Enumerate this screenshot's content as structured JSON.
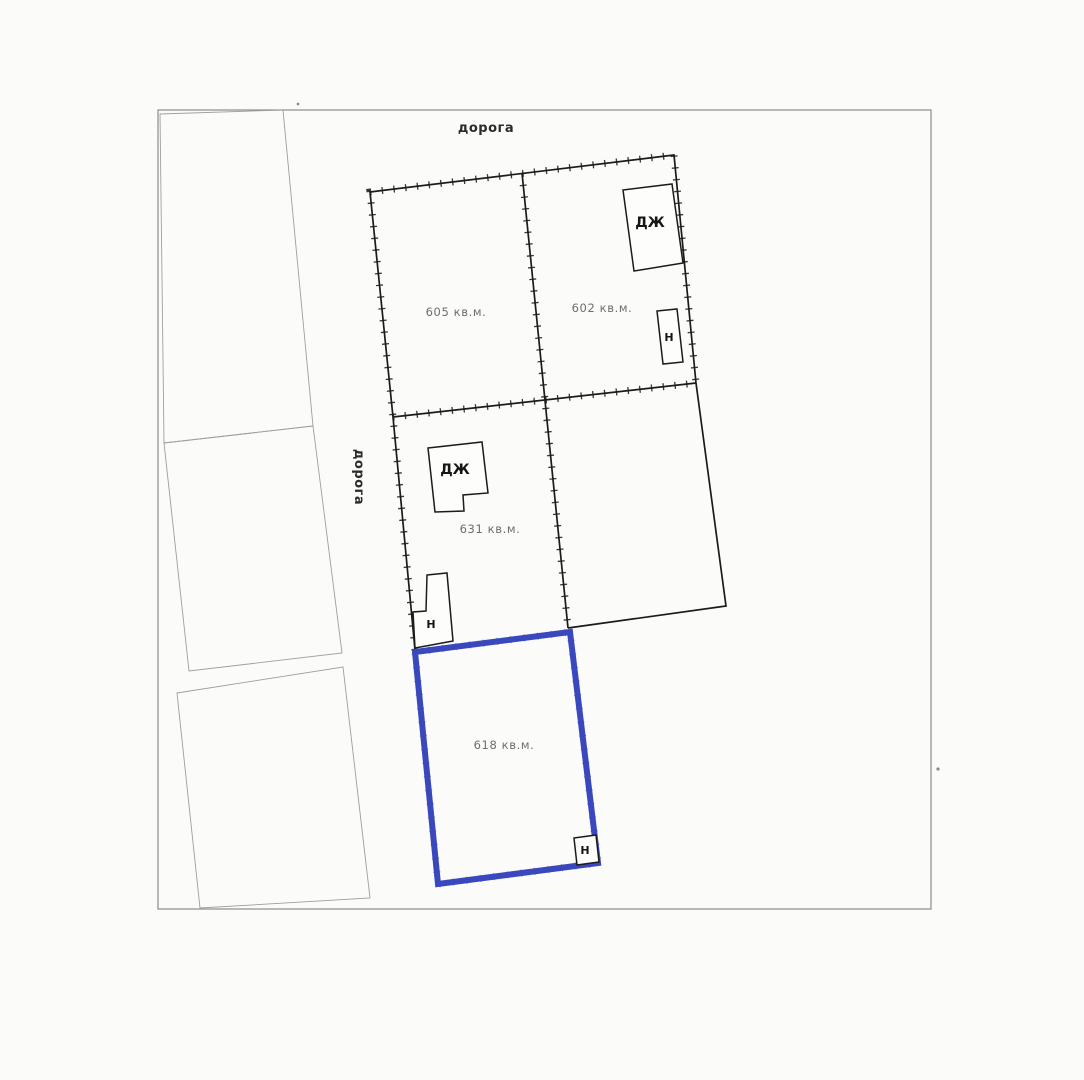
{
  "document_type": "cadastral-site-plan-scan",
  "colors": {
    "highlight": "#3a48be",
    "line": "#1b1b1b",
    "faint": "#9e9e9e",
    "sheet_border": "#8c8c8c",
    "area_text": "#6e6e6e",
    "label_text": "#2b2b2b",
    "background": "#fbfbfa"
  },
  "labels": {
    "road_top": "дорога",
    "road_left": "дорога"
  },
  "parcels": {
    "p605": {
      "area": "605 кв.м."
    },
    "p602": {
      "area": "602 кв.м."
    },
    "p631": {
      "area": "631 кв.м."
    },
    "p618": {
      "area": "618 кв.м.",
      "highlighted": true,
      "highlight_color": "#3a48be"
    }
  },
  "buildings": {
    "dzh1": {
      "label": "ДЖ"
    },
    "n1": {
      "label": "Н"
    },
    "dzh2": {
      "label": "ДЖ"
    },
    "n2": {
      "label": "Н"
    },
    "n3": {
      "label": "Н"
    }
  }
}
